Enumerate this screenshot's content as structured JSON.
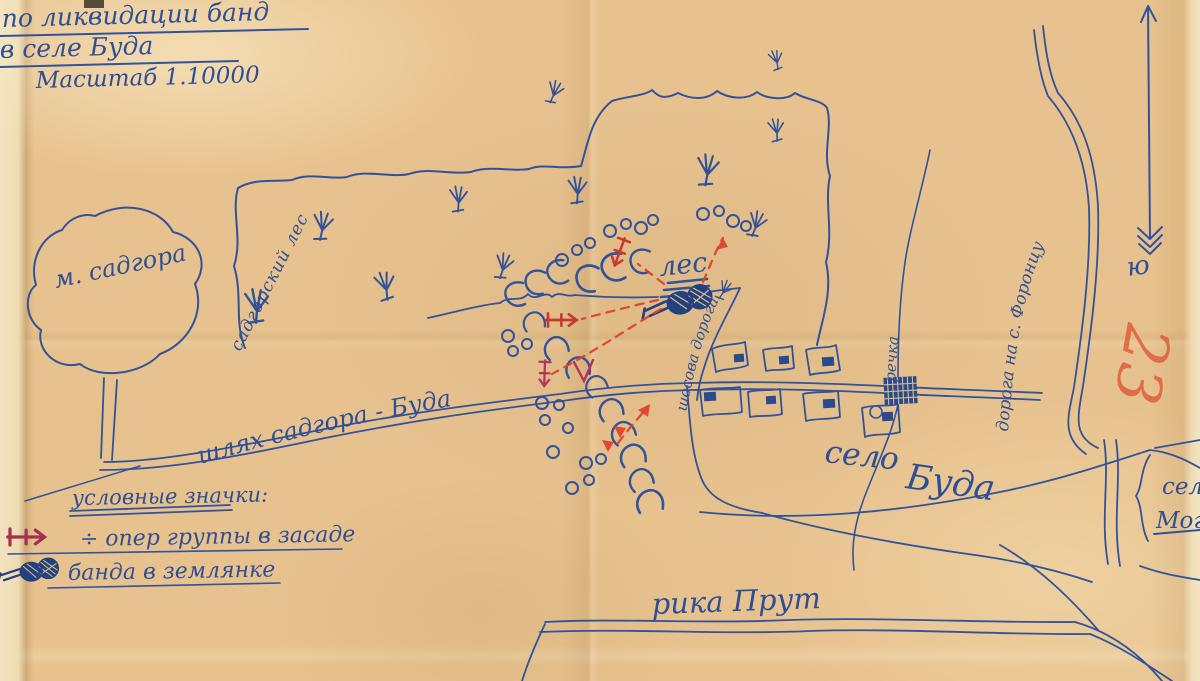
{
  "map": {
    "title": {
      "line1": "по ликвидации банд",
      "line2": "в селе Буда",
      "line3": "Масштаб 1.10000"
    },
    "labels": {
      "town": "м. садгора",
      "forest_area": "садгорский лес",
      "forest": "лес",
      "forest_road": "шосова дорога",
      "main_road": "шлях садгора - Буда",
      "village_word1": "село",
      "village_word2": "Буда",
      "stream": "речка",
      "right_road": "дорога на с. Форонцу",
      "river": "рика Прут",
      "south": "ю",
      "edge_label_top": "сел",
      "edge_label_bottom": "Мог"
    },
    "annotations": {
      "red_number": "23"
    },
    "legend": {
      "title": "условные значки:",
      "item1": "÷ опер группы в засаде",
      "item2": "банда в землянке"
    },
    "colors": {
      "ink_blue": "#2e4f96",
      "red_pencil": "#dd4430",
      "magenta_pencil": "#b5355c",
      "paper": "#e7c28e"
    }
  }
}
